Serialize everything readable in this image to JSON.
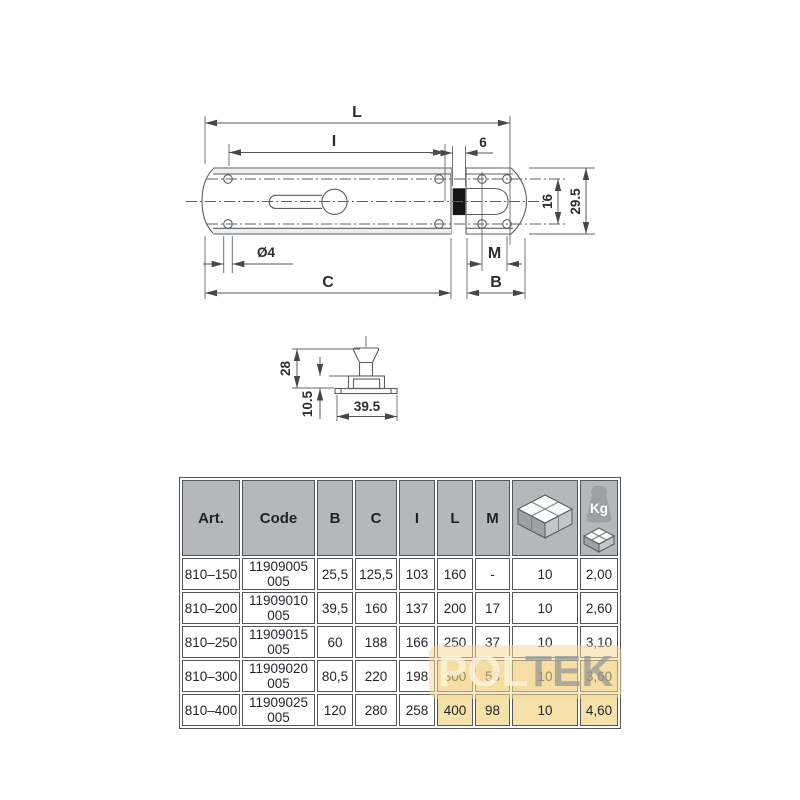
{
  "drawing": {
    "top_view": {
      "labels": {
        "L": "L",
        "I": "I",
        "gap": "6",
        "holes": "16",
        "height": "29.5",
        "diameter": "Ø4",
        "C": "C",
        "M": "M",
        "B": "B"
      }
    },
    "side_view": {
      "labels": {
        "height": "28",
        "base": "10.5",
        "width": "39.5"
      }
    }
  },
  "table": {
    "headers": {
      "art": "Art.",
      "code": "Code",
      "b": "B",
      "c": "C",
      "i": "I",
      "l": "L",
      "m": "M"
    },
    "kg_label": "Kg",
    "rows": [
      {
        "art": "810–150",
        "code": "11909005 005",
        "b": "25,5",
        "c": "125,5",
        "i": "103",
        "l": "160",
        "m": "-",
        "pack": "10",
        "kg": "2,00"
      },
      {
        "art": "810–200",
        "code": "11909010 005",
        "b": "39,5",
        "c": "160",
        "i": "137",
        "l": "200",
        "m": "17",
        "pack": "10",
        "kg": "2,60"
      },
      {
        "art": "810–250",
        "code": "11909015 005",
        "b": "60",
        "c": "188",
        "i": "166",
        "l": "250",
        "m": "37",
        "pack": "10",
        "kg": "3,10"
      },
      {
        "art": "810–300",
        "code": "11909020 005",
        "b": "80,5",
        "c": "220",
        "i": "198",
        "l": "300",
        "m": "58",
        "pack": "10",
        "kg": "3,60"
      },
      {
        "art": "810–400",
        "code": "11909025 005",
        "b": "120",
        "c": "280",
        "i": "258",
        "l": "400",
        "m": "98",
        "pack": "10",
        "kg": "4,60"
      }
    ]
  },
  "watermark": {
    "light": "POL",
    "dark": "TEK"
  },
  "colors": {
    "header_bg": "#b5b7b9",
    "watermark_tan": "#f3d99f",
    "line": "#55585a",
    "bolt_black": "#141414"
  }
}
